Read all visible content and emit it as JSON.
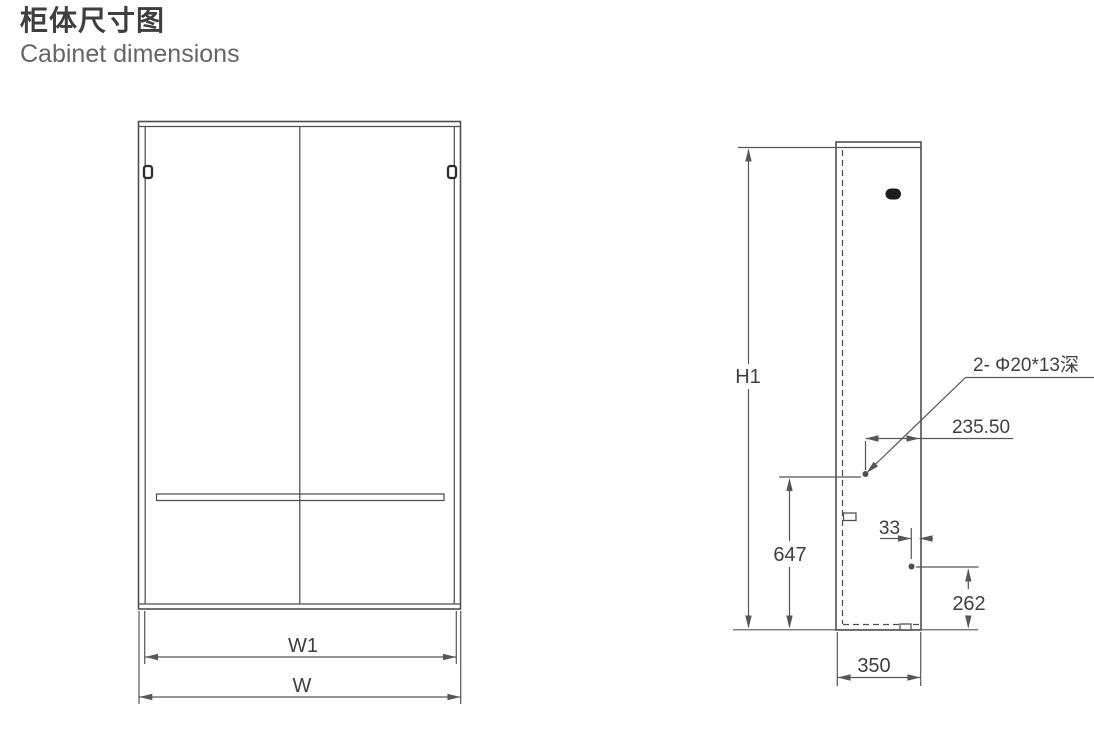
{
  "header": {
    "title": "柜体尺寸图",
    "subtitle": "Cabinet dimensions"
  },
  "colors": {
    "background": "#ffffff",
    "outline": "#4f4f4f",
    "dim_line": "#565656",
    "text": "#3f3f3f",
    "knob": "#1d1d1d"
  },
  "front_view": {
    "dim_w1": "W1",
    "dim_w": "W"
  },
  "side_view": {
    "dim_h1": "H1",
    "dim_647": "647",
    "dim_235_50": "235.50",
    "dim_33": "33",
    "dim_262": "262",
    "dim_350": "350",
    "hole_annotation": "2- Φ20*13深"
  }
}
